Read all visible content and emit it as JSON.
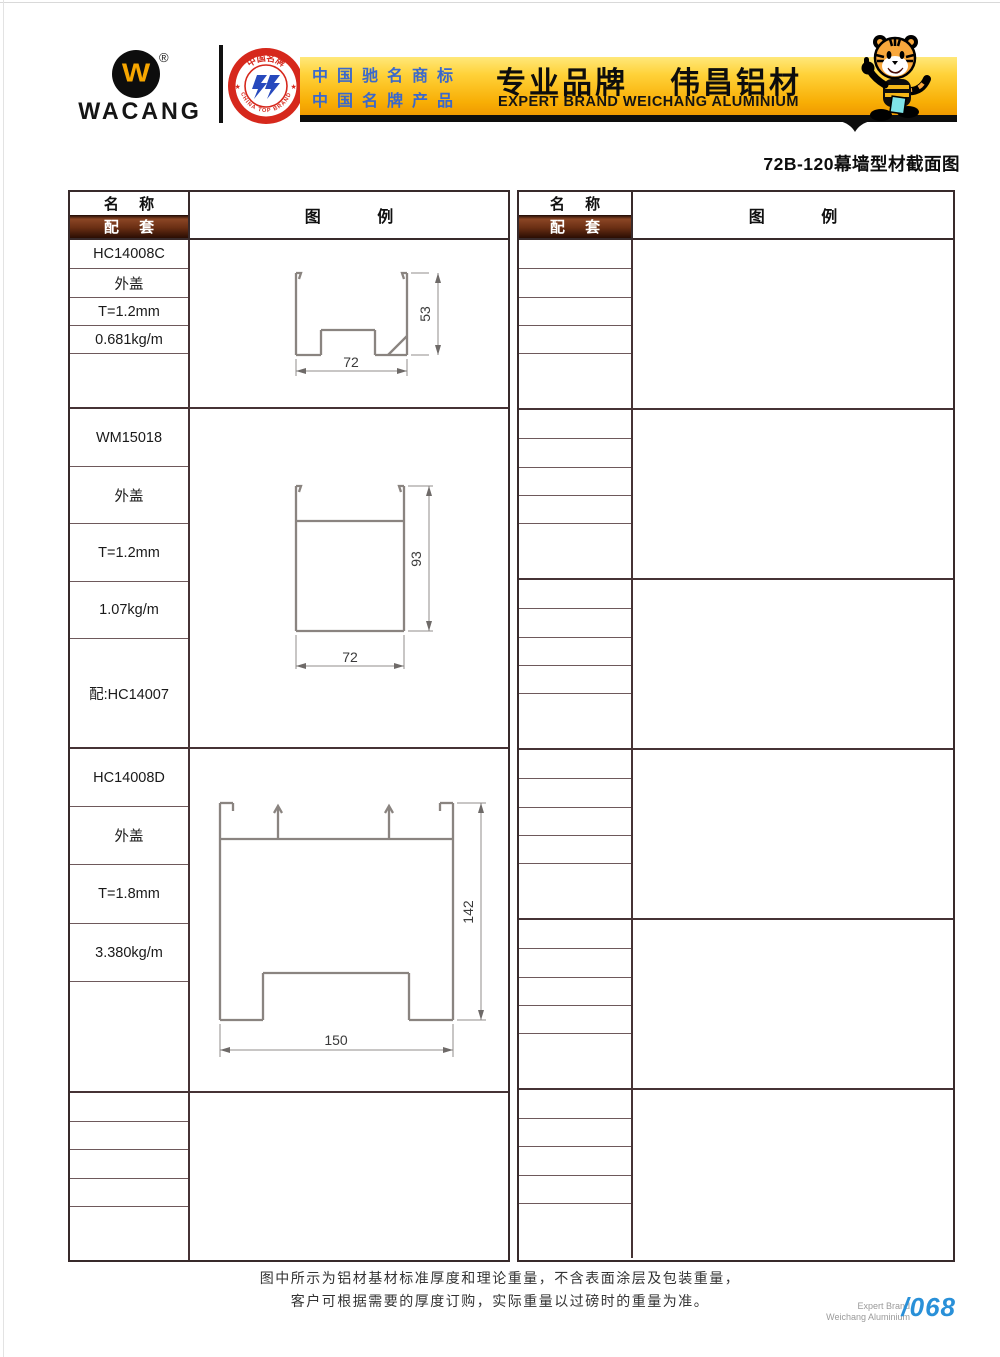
{
  "header": {
    "logo": {
      "brand": "WACANG",
      "w_mark": "W",
      "registered": "®"
    },
    "badge": {
      "top_text": "中国名牌",
      "bottom_text": "CHINA TOP BRAND"
    },
    "banner": {
      "claim_line1": "中国驰名商标",
      "claim_line2": "中国名牌产品",
      "title_cn_left": "专业品牌",
      "title_cn_right": "伟昌铝材",
      "title_en": "EXPERT BRAND WEICHANG ALUMINIUM"
    }
  },
  "page": {
    "section_title": "72B-120幕墙型材截面图",
    "footer_line1": "图中所示为铝材基材标准厚度和理论重量，不含表面涂层及包装重量，",
    "footer_line2": "客户可根据需要的厚度订购，实际重量以过磅时的重量为准。",
    "page_brand_line1": "Expert Brand",
    "page_brand_line2": "Weichang Aluminium",
    "page_number": "/068"
  },
  "table": {
    "header_name": "名 称",
    "header_match": "配 套",
    "header_legend": "图 例"
  },
  "profiles": [
    {
      "name": "HC14008C",
      "type": "外盖",
      "thickness": "T=1.2mm",
      "weight": "0.681kg/m",
      "match": "",
      "dim_width": "72",
      "dim_height": "53"
    },
    {
      "name": "WM15018",
      "type": "外盖",
      "thickness": "T=1.2mm",
      "weight": "1.07kg/m",
      "match": "配:HC14007",
      "dim_width": "72",
      "dim_height": "93"
    },
    {
      "name": "HC14008D",
      "type": "外盖",
      "thickness": "T=1.8mm",
      "weight": "3.380kg/m",
      "match": "",
      "dim_width": "150",
      "dim_height": "142"
    }
  ],
  "colors": {
    "banner_gold": "#f8ae05",
    "claim_blue": "#3a68cc",
    "match_header_brown": "#6b2f14",
    "page_number_blue": "#2990d8",
    "badge_red": "#d6281c",
    "tiger_orange": "#f9a83c"
  }
}
